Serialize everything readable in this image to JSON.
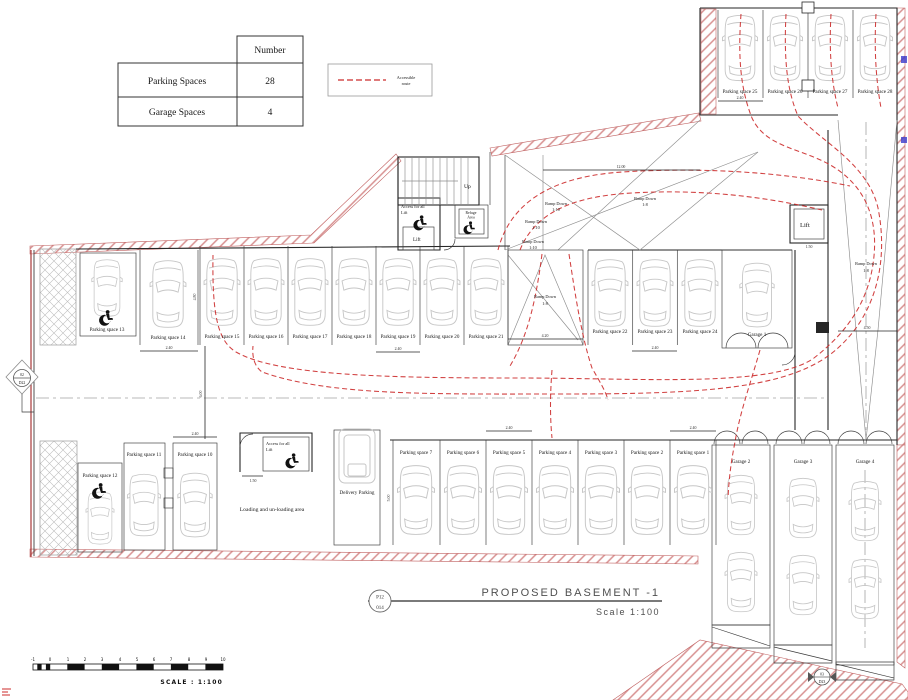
{
  "summary_table": {
    "header": "Number",
    "rows": [
      {
        "label": "Parking Spaces",
        "value": "28"
      },
      {
        "label": "Garage Spaces",
        "value": "4"
      }
    ]
  },
  "legend": {
    "line1": "Accessible",
    "line2": "route"
  },
  "plan": {
    "spaces": [
      "Parking space 1",
      "Parking space 2",
      "Parking space 3",
      "Parking space 4",
      "Parking space 5",
      "Parking space 6",
      "Parking space 7",
      "Parking space 8",
      "Parking space 9",
      "Parking space 10",
      "Parking space 11",
      "Parking space 12",
      "Parking space 13",
      "Parking space 14",
      "Parking space 15",
      "Parking space 16",
      "Parking space 17",
      "Parking space 18",
      "Parking space 19",
      "Parking space 20",
      "Parking space 21",
      "Parking space 22",
      "Parking space 23",
      "Parking space 24",
      "Parking space 25",
      "Parking space 26",
      "Parking space 27",
      "Parking space 28"
    ],
    "garages": [
      "Garage 1",
      "Garage 2",
      "Garage 3",
      "Garage 4"
    ],
    "ramp": {
      "down": "Ramp Down",
      "g110": "1:10",
      "g18": "1:8"
    },
    "rooms": {
      "up": "Up",
      "lift": "Lift",
      "access_line1": "Access for all",
      "access_line2": "Lift",
      "refuge_line1": "Refuge",
      "refuge_line2": "Area",
      "loading": "Loading and un-loading area",
      "delivery": "Delivery Parking"
    },
    "dims": {
      "d240": "2.40",
      "d420": "4.20",
      "d450": "4.50",
      "d1200": "12.00",
      "d600": "6.00",
      "d150": "1.50",
      "d480": "4.80",
      "d500": "5.00"
    },
    "markers": {
      "left_top": "02",
      "left_bottom": "D22",
      "br_top": "03",
      "br_bottom": "D23"
    }
  },
  "title_block": {
    "title": "PROPOSED  BASEMENT  -1",
    "scale": "Scale  1:100",
    "ref_top": "P12",
    "ref_bottom": "014"
  },
  "scale_bar": {
    "caption": "SCALE : 1:100",
    "ticks": [
      "-1",
      "0",
      "1",
      "2",
      "3",
      "4",
      "5",
      "6",
      "7",
      "8",
      "9",
      "10"
    ]
  },
  "colors": {
    "route": "#cc2b2b",
    "wall": "#262626",
    "car": "#c6c6c6",
    "hatch_pink": "#cc7777",
    "hatch_grey": "#b5b5b5",
    "centerline": "#a3a3a3",
    "accent_blue": "#3a3acc"
  }
}
